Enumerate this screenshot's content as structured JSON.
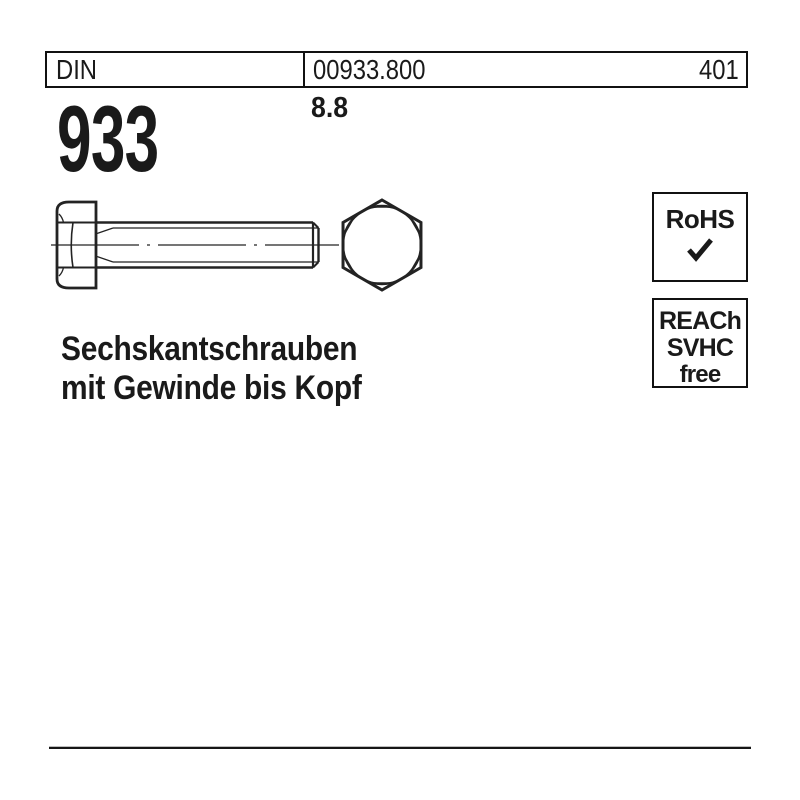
{
  "colors": {
    "ink": "#1a1a1a",
    "background": "#ffffff"
  },
  "header": {
    "standard": "DIN",
    "article_number": "00933.800",
    "page_number": "401",
    "din_number": "933",
    "strength_class": "8.8"
  },
  "drawing": {
    "subject": "hex-head-bolt",
    "views": [
      "side-view-with-centerline",
      "hexagon-head-on-view"
    ]
  },
  "badges": {
    "rohs": {
      "label": "RoHS",
      "check_icon": "✓"
    },
    "reach": {
      "line1": "REACh",
      "line2": "SVHC",
      "line3": "free"
    }
  },
  "title": {
    "line1": "Sechskantschrauben",
    "line2": "mit Gewinde bis Kopf"
  }
}
